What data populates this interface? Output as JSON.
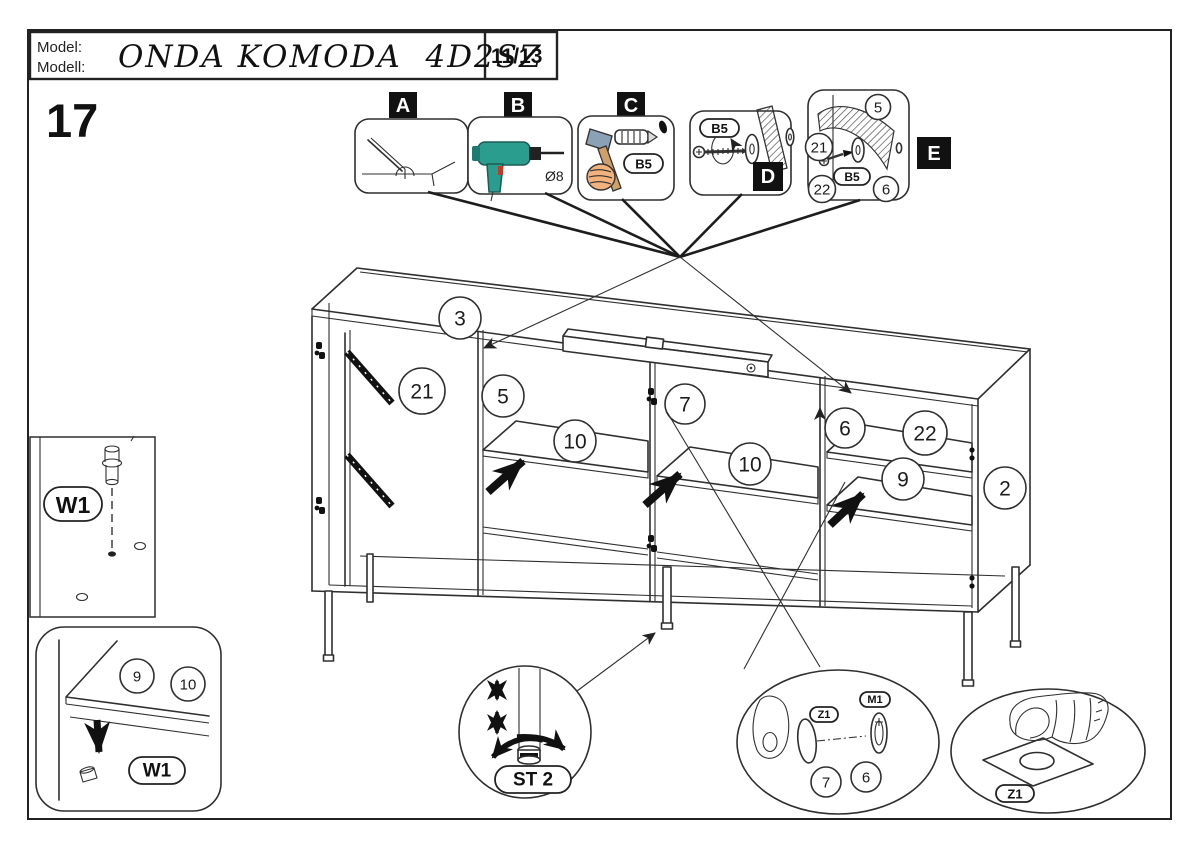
{
  "header": {
    "model_label_line1": "Model:",
    "model_label_line2": "Modell:",
    "model_name": "ONDA KOMODA  4D2SZ",
    "page_indicator": "11/13"
  },
  "step": {
    "number": "17"
  },
  "callouts": {
    "a": {
      "label": "A"
    },
    "b": {
      "label": "B",
      "drill_diameter": "Ø8"
    },
    "c": {
      "label": "C",
      "part_code": "B5"
    },
    "d": {
      "label": "D",
      "part_code": "B5"
    },
    "e": {
      "label": "E",
      "part_code": "B5",
      "parts": {
        "p5": "5",
        "p21": "21",
        "p22": "22",
        "p6": "6"
      }
    }
  },
  "parts": {
    "top_panel": "3",
    "partition_21": "21",
    "partition_5": "5",
    "partition_7": "7",
    "partition_6": "6",
    "shelf_22": "22",
    "side_panel_2": "2",
    "shelf_10_left": "10",
    "shelf_10_right": "10",
    "shelf_9": "9"
  },
  "details": {
    "foot_panel": {
      "code": "W1"
    },
    "shelf_pin": {
      "part_9": "9",
      "part_10": "10",
      "code": "W1"
    },
    "leveling": {
      "code": "ST 2"
    },
    "hinge_magnet": {
      "sticker_code": "Z1",
      "magnet_code": "M1",
      "part_7": "7",
      "part_6": "6"
    },
    "sticker": {
      "code": "Z1"
    }
  },
  "colors": {
    "line": "#2f2f2f",
    "black": "#111111",
    "drill_teal": "#2a9d8f",
    "drill_teal_dark": "#1d7a70",
    "hammer_head": "#8ba1b5",
    "wood_handle": "#cfa06a",
    "skin": "#f2b27d",
    "trigger_red": "#c0392b"
  }
}
